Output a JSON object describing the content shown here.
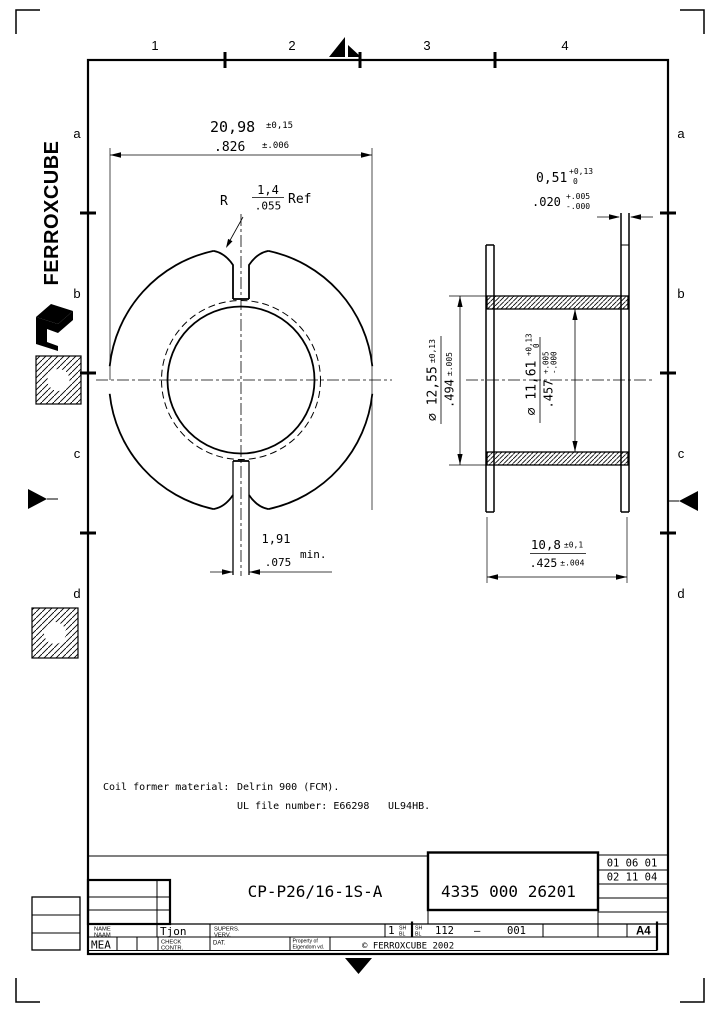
{
  "frame": {
    "cols": [
      "1",
      "2",
      "3",
      "4"
    ],
    "rows": [
      "a",
      "b",
      "c",
      "d"
    ]
  },
  "brand": {
    "logo_text": "FERROXCUBE"
  },
  "left_view": {
    "width_dim": {
      "mm": "20,98",
      "mm_tol": "±0,15",
      "inch": ".826",
      "inch_tol": "±.006"
    },
    "radius_label": {
      "prefix": "R",
      "mm": "1,4",
      "inch": ".055",
      "suffix": "Ref"
    },
    "slot_dim": {
      "mm": "1,91",
      "inch": ".075",
      "suffix": "min."
    }
  },
  "right_view": {
    "flange_dim": {
      "mm": "0,51",
      "mm_tol_hi": "+0,13",
      "mm_tol_lo": "0",
      "inch": ".020",
      "inch_tol_hi": "+.005",
      "inch_tol_lo": "-.000"
    },
    "outer_dia": {
      "mm_label": "⌀ 12,55",
      "mm_tol": "±0,13",
      "inch_label": ".494",
      "inch_tol": "±.005"
    },
    "inner_dia": {
      "mm_label": "⌀ 11,61",
      "mm_tol_hi": "+0,13",
      "mm_tol_lo": "0",
      "inch_label": ".457",
      "inch_tol_hi": "+.005",
      "inch_tol_lo": "-.000"
    },
    "height_dim": {
      "mm": "10,8",
      "mm_tol": "±0,1",
      "inch": ".425",
      "inch_tol": "±.004"
    }
  },
  "notes": {
    "material_label": "Coil former material:",
    "material_value": "Delrin 900 (FCM).",
    "ul_label": "UL file number: E66298",
    "ul_rating": "UL94HB."
  },
  "title_block": {
    "part_name": "CP-P26/16-1S-A",
    "part_number": "4335 000 26201",
    "date1": "01 06 01",
    "date2": "02 11 04",
    "name_label": "NAME",
    "naam_label": "NAAM",
    "name_value": "Tjon",
    "supers_label": "SUPERS.",
    "verv_label": "VERV.",
    "check_label": "CHECK",
    "contr_label": "CONTR.",
    "dat_label": "DAT.",
    "mea_label": "MEA",
    "sheet_value": "1",
    "sh_label": "SH",
    "bl_label": "BL",
    "code_a": "112",
    "code_dash": "–",
    "code_b": "001",
    "format_label": "A4",
    "property_label": "Property of",
    "property_label2": "Eigendom vd.",
    "copyright": "© FERROXCUBE 2002"
  }
}
